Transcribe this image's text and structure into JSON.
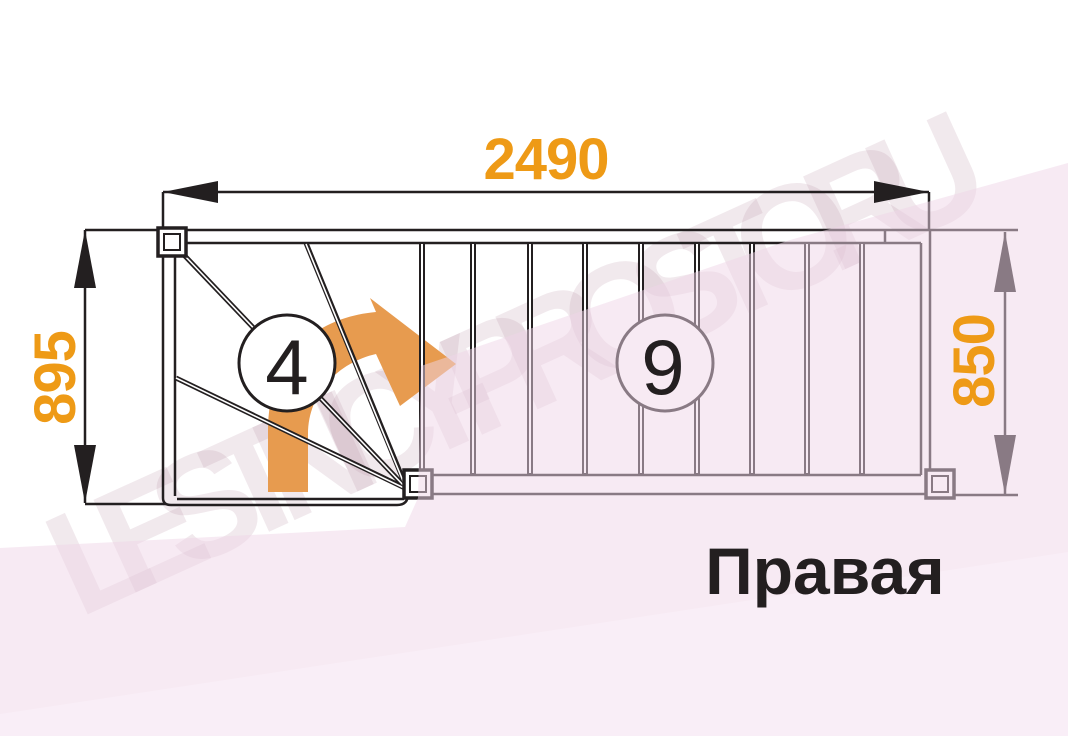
{
  "diagram": {
    "type_label": "Правая",
    "dimensions": {
      "total_length_mm": "2490",
      "left_flight_width_mm": "895",
      "right_flight_width_mm": "850"
    },
    "step_counts": {
      "winder_steps": "4",
      "straight_steps": "9"
    },
    "watermark_text": "LESTNICY-PROSTO.RU",
    "colors": {
      "dimension_text": "#ee9a16",
      "direction_arrow": "#e79b4f",
      "plan_lines": "#231f20",
      "background_tint_main": "#f7ebf2",
      "background_tint_bottom": "#fbf0f6",
      "paper": "#ffffff"
    }
  }
}
